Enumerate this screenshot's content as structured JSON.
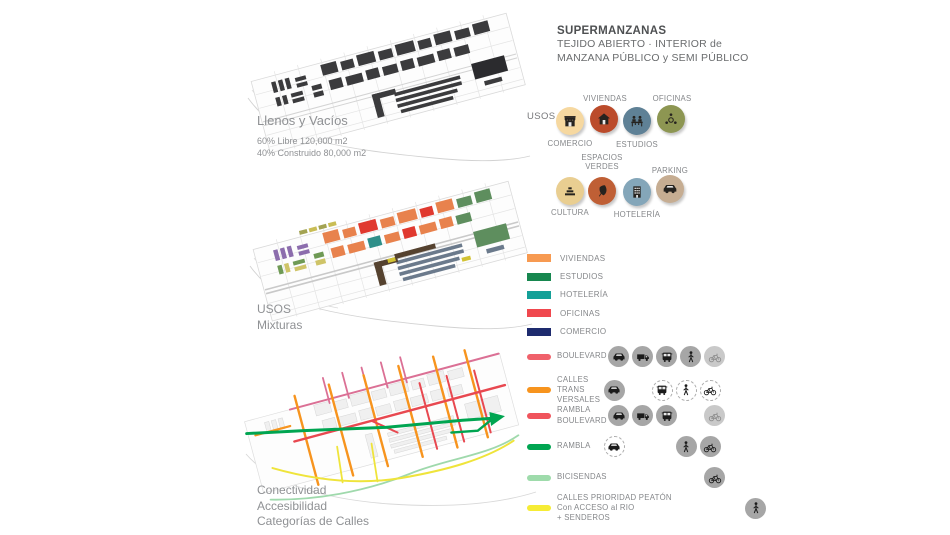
{
  "header": {
    "title": "SUPERMANZANAS",
    "subtitle1": "TEJIDO ABIERTO · INTERIOR de",
    "subtitle2": "MANZANA PÚBLICO y SEMI PÚBLICO"
  },
  "maps": {
    "map1": {
      "title": "Llenos y Vacíos",
      "stat1": "60% Libre 120,000 m2",
      "stat2": "40% Construido 80,000 m2"
    },
    "map2": {
      "line1": "USOS",
      "line2": "Mixturas"
    },
    "map3": {
      "line1": "Conectividad",
      "line2": "Accesibilidad",
      "line3": "Categorías de Calles"
    }
  },
  "usos": {
    "label": "USOS",
    "items": [
      {
        "name": "COMERCIO",
        "icon": "store-icon",
        "circle_color": "#F6D8A0"
      },
      {
        "name": "VIVIENDAS",
        "icon": "home-icon",
        "circle_color": "#BB4B2B"
      },
      {
        "name": "ESTUDIOS",
        "icon": "students-icon",
        "circle_color": "#5F8196"
      },
      {
        "name": "OFICINAS",
        "icon": "meeting-icon",
        "circle_color": "#8D9652"
      },
      {
        "name": "CULTURA",
        "icon": "culture-icon",
        "circle_color": "#E9CE91"
      },
      {
        "name": "ESPACIOS VERDES",
        "label_line1": "ESPACIOS",
        "label_line2": "VERDES",
        "icon": "leaf-icon",
        "circle_color": "#BF5F35"
      },
      {
        "name": "HOTELERÍA",
        "icon": "hotel-icon",
        "circle_color": "#84A6B9"
      },
      {
        "name": "PARKING",
        "icon": "car-icon",
        "circle_color": "#C6AD92"
      }
    ]
  },
  "uses_legend": [
    {
      "label": "VIVIENDAS",
      "color": "#F79A51"
    },
    {
      "label": "ESTUDIOS",
      "color": "#17874F"
    },
    {
      "label": "HOTELERÍA",
      "color": "#14A098"
    },
    {
      "label": "OFICINAS",
      "color": "#F0484E"
    },
    {
      "label": "COMERCIO",
      "color": "#1E2B6E"
    }
  ],
  "street_legend": [
    {
      "label1": "BOULEVARD",
      "color": "#F0616B",
      "modes": [
        "car:solid",
        "truck:solid",
        "bus:solid",
        "walk:solid",
        "bike:faded"
      ]
    },
    {
      "label1": "CALLES",
      "label2": "TRANS",
      "label3": "VERSALES",
      "color": "#F7941E",
      "modes": [
        "car:solid",
        "",
        "bus:dashed",
        "walk:dashed",
        "bike:dashed"
      ]
    },
    {
      "label1": "RAMBLA",
      "label2": "BOULEVARD",
      "color": "#F0545C",
      "modes": [
        "car:solid",
        "truck:solid",
        "bus:solid",
        "",
        "bike:faded"
      ]
    },
    {
      "label1": "RAMBLA",
      "color": "#00A551",
      "modes": [
        "car:dashed",
        "",
        "",
        "walk:solid",
        "bike:solid"
      ]
    },
    {
      "label1": "BICISENDAS",
      "color": "#9EDBAB",
      "modes": [
        "",
        "",
        "",
        "",
        "bike:solid"
      ]
    },
    {
      "label1": "CALLES PRIORIDAD PEATÓN",
      "label2": "Con ACCESO al RIO",
      "label3": "+ SENDEROS",
      "color": "#F6EC35",
      "modes": [
        "",
        "",
        "",
        "walk:solid",
        ""
      ]
    }
  ]
}
